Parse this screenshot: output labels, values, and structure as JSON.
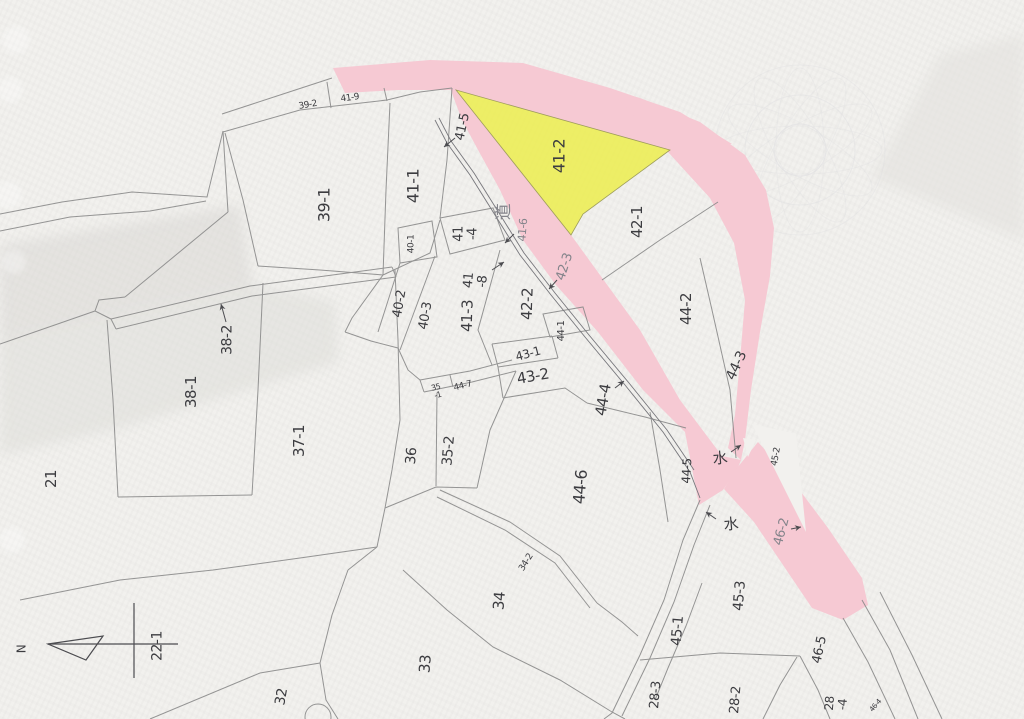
{
  "map": {
    "type": "japanese-cadastral-map",
    "highlighted_parcel": "41-2",
    "highlighted_parcel_color": "#ecee5e",
    "highlighted_road_color": "#f6c9d3",
    "line_color": "#8a8a8a",
    "label_color": "#3c3c40",
    "road_kanji": "道",
    "water_kanji": "水",
    "north_label": "N",
    "benchmark_parcel": "22-1"
  },
  "labels": [
    {
      "text": "39-2",
      "x": 308,
      "y": 106,
      "rot": -10,
      "size": 9
    },
    {
      "text": "41-9",
      "x": 350,
      "y": 99,
      "rot": -8,
      "size": 9
    },
    {
      "text": "39-1",
      "x": 325,
      "y": 205,
      "rot": -90,
      "size": 16
    },
    {
      "text": "41-1",
      "x": 414,
      "y": 186,
      "rot": -90,
      "size": 16
    },
    {
      "text": "41-5",
      "x": 463,
      "y": 127,
      "rot": -78,
      "size": 13
    },
    {
      "text": "41-2",
      "x": 560,
      "y": 156,
      "rot": -90,
      "size": 16
    },
    {
      "text": "道",
      "x": 505,
      "y": 212,
      "rot": -90,
      "size": 17,
      "dim": true
    },
    {
      "text": "41-6",
      "x": 523,
      "y": 230,
      "rot": -85,
      "size": 11,
      "dim": true
    },
    {
      "text": "41\n-4",
      "x": 466,
      "y": 234,
      "rot": -90,
      "size": 13
    },
    {
      "text": "40-1",
      "x": 412,
      "y": 244,
      "rot": -90,
      "size": 9
    },
    {
      "text": "41\n-8",
      "x": 476,
      "y": 281,
      "rot": -85,
      "size": 13
    },
    {
      "text": "40-2",
      "x": 400,
      "y": 304,
      "rot": -80,
      "size": 13
    },
    {
      "text": "40-3",
      "x": 426,
      "y": 316,
      "rot": -80,
      "size": 13
    },
    {
      "text": "41-3",
      "x": 468,
      "y": 316,
      "rot": -88,
      "size": 15
    },
    {
      "text": "42-2",
      "x": 528,
      "y": 304,
      "rot": -88,
      "size": 15
    },
    {
      "text": "42-3",
      "x": 565,
      "y": 267,
      "rot": -72,
      "size": 13,
      "dim": true
    },
    {
      "text": "42-1",
      "x": 638,
      "y": 222,
      "rot": -90,
      "size": 15
    },
    {
      "text": "44-2",
      "x": 687,
      "y": 309,
      "rot": -90,
      "size": 15
    },
    {
      "text": "44-3",
      "x": 737,
      "y": 366,
      "rot": -65,
      "size": 14
    },
    {
      "text": "44-1",
      "x": 562,
      "y": 331,
      "rot": -90,
      "size": 10
    },
    {
      "text": "43-1",
      "x": 528,
      "y": 354,
      "rot": -15,
      "size": 12
    },
    {
      "text": "43-2",
      "x": 533,
      "y": 377,
      "rot": -10,
      "size": 15
    },
    {
      "text": "44-4",
      "x": 604,
      "y": 400,
      "rot": -80,
      "size": 15
    },
    {
      "text": "35\n-1",
      "x": 437,
      "y": 392,
      "rot": -15,
      "size": 8
    },
    {
      "text": "44-7",
      "x": 463,
      "y": 387,
      "rot": -14,
      "size": 9
    },
    {
      "text": "38-2",
      "x": 228,
      "y": 340,
      "rot": -90,
      "size": 14
    },
    {
      "text": "38-1",
      "x": 192,
      "y": 392,
      "rot": -90,
      "size": 15
    },
    {
      "text": "37-1",
      "x": 300,
      "y": 441,
      "rot": -90,
      "size": 15
    },
    {
      "text": "21",
      "x": 52,
      "y": 479,
      "rot": -90,
      "size": 15
    },
    {
      "text": "36",
      "x": 412,
      "y": 456,
      "rot": -85,
      "size": 14
    },
    {
      "text": "35-2",
      "x": 449,
      "y": 451,
      "rot": -85,
      "size": 14
    },
    {
      "text": "44-6",
      "x": 581,
      "y": 487,
      "rot": -85,
      "size": 16
    },
    {
      "text": "44-5",
      "x": 687,
      "y": 471,
      "rot": -87,
      "size": 12
    },
    {
      "text": "水",
      "x": 720,
      "y": 459,
      "rot": -5,
      "size": 15
    },
    {
      "text": "45-2",
      "x": 777,
      "y": 457,
      "rot": -80,
      "size": 9
    },
    {
      "text": "水",
      "x": 731,
      "y": 525,
      "rot": -5,
      "size": 15
    },
    {
      "text": "46-2",
      "x": 782,
      "y": 532,
      "rot": -75,
      "size": 13,
      "dim": true
    },
    {
      "text": "45-3",
      "x": 740,
      "y": 596,
      "rot": -85,
      "size": 14
    },
    {
      "text": "45-1",
      "x": 678,
      "y": 631,
      "rot": -85,
      "size": 14
    },
    {
      "text": "46-5",
      "x": 820,
      "y": 650,
      "rot": -78,
      "size": 13
    },
    {
      "text": "28-3",
      "x": 656,
      "y": 695,
      "rot": -85,
      "size": 13
    },
    {
      "text": "28-2",
      "x": 736,
      "y": 700,
      "rot": -85,
      "size": 13
    },
    {
      "text": "28\n-4",
      "x": 836,
      "y": 704,
      "rot": -85,
      "size": 12
    },
    {
      "text": "46-4",
      "x": 876,
      "y": 706,
      "rot": -50,
      "size": 7
    },
    {
      "text": "34",
      "x": 500,
      "y": 601,
      "rot": -85,
      "size": 15
    },
    {
      "text": "34-2",
      "x": 527,
      "y": 563,
      "rot": -58,
      "size": 9
    },
    {
      "text": "33",
      "x": 426,
      "y": 664,
      "rot": -85,
      "size": 15
    },
    {
      "text": "32",
      "x": 282,
      "y": 697,
      "rot": -80,
      "size": 14
    },
    {
      "text": "22-1",
      "x": 158,
      "y": 646,
      "rot": -90,
      "size": 14
    },
    {
      "text": "N",
      "x": 22,
      "y": 649,
      "rot": -90,
      "size": 12
    }
  ]
}
